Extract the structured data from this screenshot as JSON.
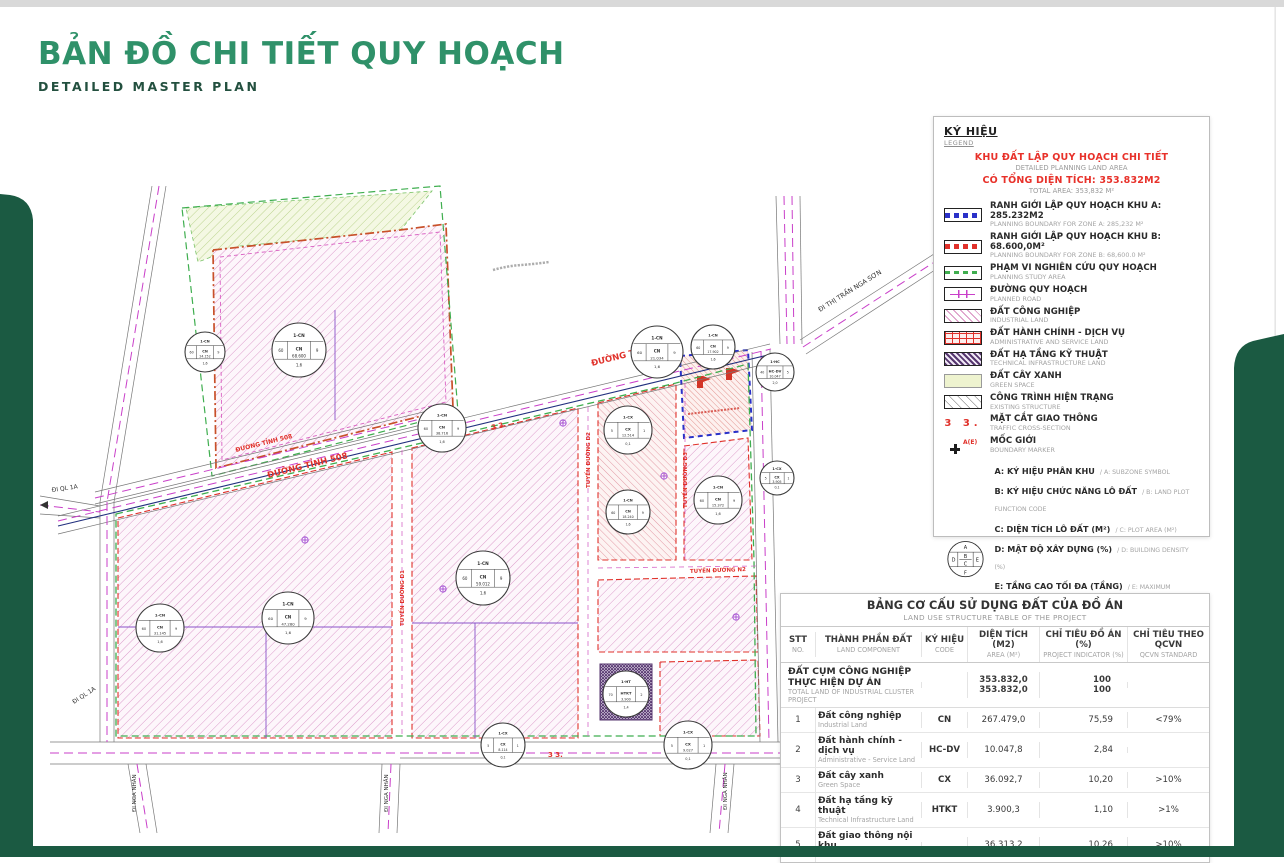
{
  "page": {
    "title": "BẢN ĐỒ CHI TIẾT QUY HOẠCH",
    "subtitle": "DETAILED MASTER PLAN",
    "accent_green": "#2f9169",
    "corner_green": "#1b5a42",
    "legend_red": "#e8312a"
  },
  "legend": {
    "heading": "KÝ HIỆU",
    "heading_en": "LEGEND",
    "kicker": "KHU ĐẤT LẬP QUY HOẠCH CHI TIẾT",
    "kicker_en": "DETAILED PLANNING LAND AREA",
    "total": "CÓ TỔNG DIỆN TÍCH: 353.832M2",
    "total_en": "TOTAL AREA: 353,832 M²",
    "items": [
      {
        "id": "zone-a",
        "vn": "RANH GIỚI LẬP QUY HOẠCH KHU A: 285.232M2",
        "en": "PLANNING BOUNDARY FOR ZONE A: 285,232 M²"
      },
      {
        "id": "zone-b",
        "vn": "RANH GIỚI LẬP QUY HOẠCH KHU B: 68.600,0M²",
        "en": "PLANNING BOUNDARY FOR ZONE B: 68,600.0 M²"
      },
      {
        "id": "study",
        "vn": "PHẠM VI NGHIÊN CỨU QUY HOẠCH",
        "en": "PLANNING STUDY AREA"
      },
      {
        "id": "road",
        "vn": "ĐƯỜNG QUY HOẠCH",
        "en": "PLANNED ROAD"
      },
      {
        "id": "industrial",
        "vn": "ĐẤT CÔNG NGHIỆP",
        "en": "INDUSTRIAL LAND"
      },
      {
        "id": "admin",
        "vn": "ĐẤT HÀNH CHÍNH - DỊCH VỤ",
        "en": "ADMINISTRATIVE AND SERVICE LAND"
      },
      {
        "id": "technical",
        "vn": "ĐẤT HẠ TẦNG KỸ THUẬT",
        "en": "TECHNICAL INFRASTRUCTURE LAND"
      },
      {
        "id": "green",
        "vn": "ĐẤT CÂY XANH",
        "en": "GREEN SPACE"
      },
      {
        "id": "existing",
        "vn": "CÔNG TRÌNH HIỆN TRẠNG",
        "en": "EXISTING STRUCTURE"
      },
      {
        "id": "cross-section",
        "sym": "3  3.",
        "vn": "MẶT CẮT GIAO THÔNG",
        "en": "TRAFFIC CROSS-SECTION"
      },
      {
        "id": "marker",
        "sym": "A(E)",
        "vn": "MỐC GIỚI",
        "en": "BOUNDARY MARKER"
      }
    ],
    "diagram": {
      "a": "A",
      "b": "B",
      "c": "C",
      "d": "D",
      "e": "E",
      "f": "F"
    },
    "plot_key": [
      {
        "vn": "A: KÝ HIỆU PHÂN KHU",
        "en": "/ A: SUBZONE SYMBOL"
      },
      {
        "vn": "B: KÝ HIỆU CHỨC NĂNG LÔ ĐẤT",
        "en": "/ B: LAND PLOT FUNCTION CODE"
      },
      {
        "vn": "C: DIỆN TÍCH LÔ ĐẤT (M²)",
        "en": "/ C: PLOT AREA (M²)"
      },
      {
        "vn": "D: MẬT ĐỘ XÂY DỰNG (%)",
        "en": "/ D: BUILDING DENSITY (%)"
      },
      {
        "vn": "E: TẦNG CAO TỐI ĐA (TẦNG)",
        "en": "/ E: MAXIMUM NUMBER OF FLOORS"
      },
      {
        "vn": "F: HỆ SỐ SỬ DỤNG ĐẤT TỐI ĐA",
        "en": "/ F: MAXIMUM FLOOR AREA RATIO (FAR)"
      }
    ]
  },
  "table": {
    "title": "BẢNG CƠ CẤU SỬ DỤNG ĐẤT CỦA ĐỒ ÁN",
    "title_en": "LAND USE STRUCTURE TABLE OF THE PROJECT",
    "columns": [
      {
        "vn": "STT",
        "en": "NO."
      },
      {
        "vn": "THÀNH PHẦN ĐẤT",
        "en": "LAND COMPONENT"
      },
      {
        "vn": "KÝ HIỆU",
        "en": "CODE"
      },
      {
        "vn": "DIỆN TÍCH (M2)",
        "en": "AREA (M²)"
      },
      {
        "vn": "CHỈ TIÊU ĐỒ ÁN (%)",
        "en": "PROJECT INDICATOR (%)"
      },
      {
        "vn": "CHỈ TIÊU THEO QCVN",
        "en": "QCVN STANDARD"
      }
    ],
    "summary": {
      "vn": "ĐẤT CỤM CÔNG NGHIỆP THỰC HIỆN DỰ ÁN",
      "en": "TOTAL LAND OF INDUSTRIAL CLUSTER PROJECT",
      "area_a": "353.832,0",
      "area_b": "353.832,0",
      "ind_a": "100",
      "ind_b": "100",
      "qcvn": ""
    },
    "rows": [
      {
        "no": "1",
        "vn": "Đất công nghiệp",
        "en": "Industrial Land",
        "code": "CN",
        "area": "267.479,0",
        "ind": "75,59",
        "qcvn": "<79%"
      },
      {
        "no": "2",
        "vn": "Đất hành chính - dịch vụ",
        "en": "Administrative - Service Land",
        "code": "HC-DV",
        "area": "10.047,8",
        "ind": "2,84",
        "qcvn": ""
      },
      {
        "no": "3",
        "vn": "Đất cây xanh",
        "en": "Green Space",
        "code": "CX",
        "area": "36.092,7",
        "ind": "10,20",
        "qcvn": ">10%"
      },
      {
        "no": "4",
        "vn": "Đất hạ tầng kỹ thuật",
        "en": "Technical Infrastructure Land",
        "code": "HTKT",
        "area": "3.900,3",
        "ind": "1,10",
        "qcvn": ">1%"
      },
      {
        "no": "5",
        "vn": "Đất giao thông nội khu",
        "en": "Internal Road Land",
        "code": "",
        "area": "36.313,2",
        "ind": "10,26",
        "qcvn": ">10%"
      }
    ]
  },
  "map": {
    "road_labels": {
      "dt508_a": "ĐƯỜNG TỈNH 508",
      "dt508_b": "ĐƯỜNG TỈNH 508",
      "dt508_c": "ĐƯỜNG TỈNH 508",
      "d1": "TUYẾN ĐƯỜNG D1",
      "d2": "TUYẾN ĐƯỜNG D2",
      "d3": "TUYẾN ĐƯỜNG D3",
      "n2": "TUYẾN ĐƯỜNG N2"
    },
    "destinations": {
      "ql1a_w": "ĐI QL 1A",
      "ql1a_s": "ĐI QL 1A",
      "ngason": "ĐI THỊ TRẤN NGA SƠN",
      "nganhan_s1": "ĐI NGA NHÂN",
      "nganhan_s2": "ĐI NGA NHÂN",
      "nganhan_s3": "ĐI NGA NHÂN"
    },
    "cross_sections": {
      "c1": "3   3.",
      "c2": "3   3."
    },
    "plot_markers": [
      {
        "x": 205,
        "y": 352,
        "r": 20,
        "top": "1-CN",
        "code": "CN",
        "area": "24.152",
        "d": "60",
        "e": "9",
        "f": "1,6"
      },
      {
        "x": 299,
        "y": 350,
        "r": 27,
        "top": "1-CN",
        "code": "CN",
        "area": "68.600",
        "d": "60",
        "e": "9",
        "f": "1,6"
      },
      {
        "x": 442,
        "y": 428,
        "r": 24,
        "top": "1-CN",
        "code": "CN",
        "area": "38.716",
        "d": "60",
        "e": "9",
        "f": "1,6"
      },
      {
        "x": 657,
        "y": 352,
        "r": 26,
        "top": "1-CN",
        "code": "CN",
        "area": "21.034",
        "d": "60",
        "e": "9",
        "f": "1,6"
      },
      {
        "x": 713,
        "y": 347,
        "r": 22,
        "top": "1-CN",
        "code": "CN",
        "area": "17.902",
        "d": "60",
        "e": "9",
        "f": "1,6"
      },
      {
        "x": 628,
        "y": 430,
        "r": 24,
        "top": "1-CX",
        "code": "CX",
        "area": "12.514",
        "d": "5",
        "e": "1",
        "f": "0,1"
      },
      {
        "x": 628,
        "y": 512,
        "r": 22,
        "top": "1-CN",
        "code": "CN",
        "area": "18.240",
        "d": "60",
        "e": "9",
        "f": "1,6"
      },
      {
        "x": 718,
        "y": 500,
        "r": 24,
        "top": "1-CN",
        "code": "CN",
        "area": "15.372",
        "d": "60",
        "e": "9",
        "f": "1,6"
      },
      {
        "x": 777,
        "y": 478,
        "r": 17,
        "top": "1-CX",
        "code": "CX",
        "area": "3.905",
        "d": "5",
        "e": "1",
        "f": "0,1"
      },
      {
        "x": 775,
        "y": 372,
        "r": 19,
        "top": "1-HC",
        "code": "HC-DV",
        "area": "10.047",
        "d": "40",
        "e": "5",
        "f": "2,0"
      },
      {
        "x": 483,
        "y": 578,
        "r": 27,
        "top": "1-CN",
        "code": "CN",
        "area": "59.012",
        "d": "60",
        "e": "9",
        "f": "1,6"
      },
      {
        "x": 288,
        "y": 618,
        "r": 26,
        "top": "1-CN",
        "code": "CN",
        "area": "47.280",
        "d": "60",
        "e": "9",
        "f": "1,6"
      },
      {
        "x": 160,
        "y": 628,
        "r": 24,
        "top": "1-CN",
        "code": "CN",
        "area": "31.145",
        "d": "60",
        "e": "9",
        "f": "1,6"
      },
      {
        "x": 626,
        "y": 694,
        "r": 23,
        "top": "1-HT",
        "code": "HTKT",
        "area": "3.900",
        "d": "70",
        "e": "2",
        "f": "1,4"
      },
      {
        "x": 503,
        "y": 745,
        "r": 22,
        "top": "1-CX",
        "code": "CX",
        "area": "8.114",
        "d": "5",
        "e": "1",
        "f": "0,1"
      },
      {
        "x": 688,
        "y": 745,
        "r": 24,
        "top": "1-CX",
        "code": "CX",
        "area": "9.027",
        "d": "5",
        "e": "1",
        "f": "0,1"
      }
    ]
  }
}
